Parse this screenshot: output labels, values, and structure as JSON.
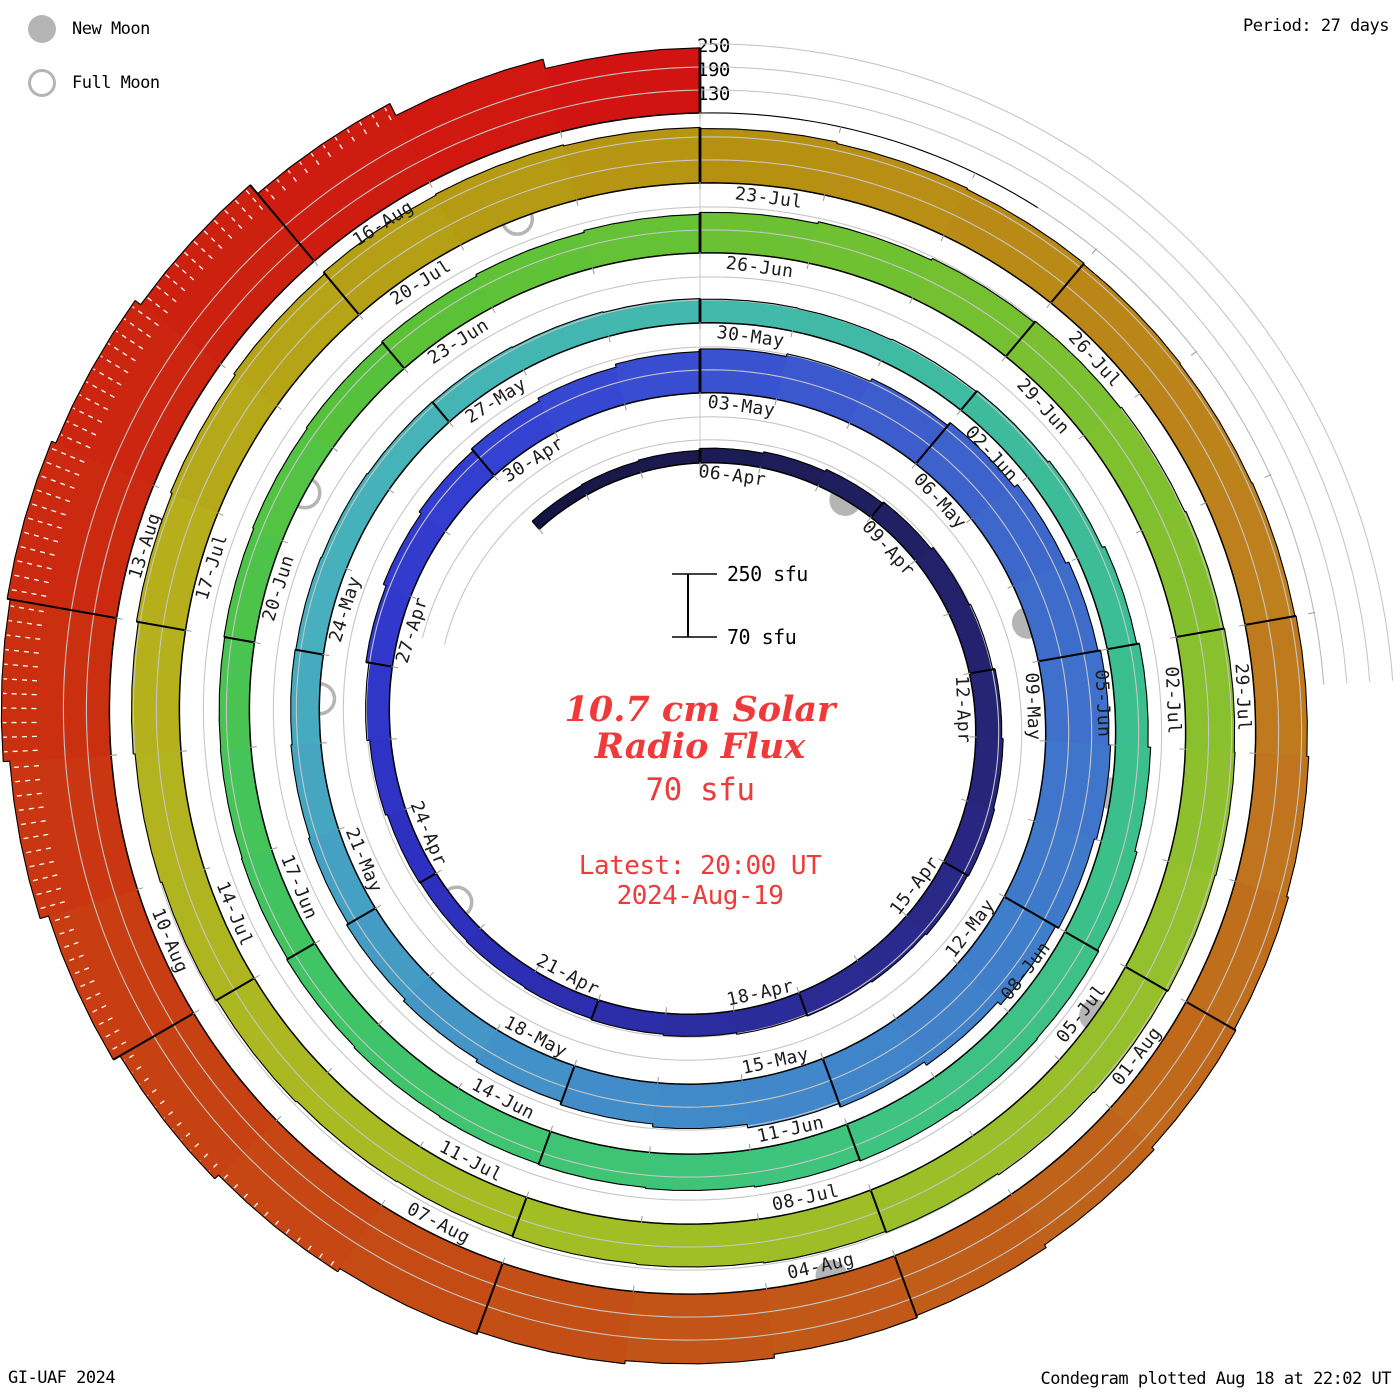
{
  "header": {
    "period_label": "Period: 27 days"
  },
  "legend": {
    "new_moon": "New Moon",
    "full_moon": "Full Moon"
  },
  "footer": {
    "left": "GI-UAF 2024",
    "right": "Condegram plotted Aug 18 at 22:02 UT"
  },
  "center": {
    "title_line1": "10.7 cm Solar",
    "title_line2": "Radio Flux",
    "value": "70 sfu",
    "latest_line1": "Latest: 20:00 UT",
    "latest_line2": "2024-Aug-19"
  },
  "scale": {
    "top": "250 sfu",
    "bottom": "70 sfu"
  },
  "axis": {
    "tick_labels": [
      "250",
      "190",
      "130"
    ]
  },
  "chart_data": {
    "type": "spiral_bar",
    "title": "10.7 cm Solar Radio Flux condegram",
    "period_days": 27,
    "segment_days": 3,
    "baseline_sfu": 70,
    "gridlines_sfu": [
      130,
      190,
      250
    ],
    "start_date": "2024-04-03",
    "end_date": "2024-08-19",
    "ring_start_labels": [
      "06-Apr",
      "03-May",
      "30-May",
      "26-Jun",
      "23-Jul"
    ],
    "segment_labels": [
      "06-Apr",
      "09-Apr",
      "12-Apr",
      "15-Apr",
      "18-Apr",
      "21-Apr",
      "24-Apr",
      "27-Apr",
      "30-Apr",
      "03-May",
      "06-May",
      "09-May",
      "12-May",
      "15-May",
      "18-May",
      "21-May",
      "24-May",
      "27-May",
      "30-May",
      "02-Jun",
      "05-Jun",
      "08-Jun",
      "11-Jun",
      "14-Jun",
      "17-Jun",
      "20-Jun",
      "23-Jun",
      "26-Jun",
      "29-Jun",
      "02-Jul",
      "05-Jul",
      "08-Jul",
      "11-Jul",
      "14-Jul",
      "17-Jul",
      "20-Jul",
      "23-Jul",
      "26-Jul",
      "29-Jul",
      "01-Aug",
      "04-Aug",
      "07-Aug",
      "10-Aug",
      "13-Aug",
      "16-Aug"
    ],
    "daily_flux_sfu": [
      98,
      100,
      103,
      108,
      112,
      118,
      122,
      128,
      132,
      138,
      142,
      145,
      142,
      138,
      135,
      132,
      128,
      125,
      122,
      120,
      118,
      120,
      125,
      132,
      140,
      148,
      155,
      162,
      170,
      178,
      185,
      192,
      200,
      210,
      220,
      228,
      235,
      240,
      234,
      225,
      215,
      205,
      195,
      186,
      178,
      170,
      163,
      157,
      152,
      148,
      145,
      143,
      141,
      139,
      138,
      136,
      134,
      132,
      131,
      133,
      136,
      141,
      148,
      155,
      162,
      168,
      172,
      174,
      172,
      168,
      165,
      162,
      160,
      158,
      155,
      152,
      150,
      149,
      151,
      154,
      157,
      161,
      166,
      171,
      176,
      181,
      186,
      190,
      193,
      196,
      198,
      200,
      198,
      195,
      192,
      188,
      185,
      182,
      180,
      178,
      180,
      183,
      186,
      190,
      195,
      200,
      205,
      210,
      215,
      218,
      215,
      212,
      208,
      205,
      202,
      200,
      202,
      205,
      210,
      215,
      220,
      228,
      236,
      242,
      252,
      260,
      268,
      278,
      292,
      312,
      335,
      352,
      360,
      348,
      330,
      300,
      265,
      240
    ],
    "moons": {
      "new": [
        {
          "date": "2024-04-08",
          "day": 5
        },
        {
          "date": "2024-05-08",
          "day": 35
        },
        {
          "date": "2024-06-06",
          "day": 64
        },
        {
          "date": "2024-07-05",
          "day": 93
        },
        {
          "date": "2024-08-04",
          "day": 123
        }
      ],
      "full": [
        {
          "date": "2024-04-23",
          "day": 20
        },
        {
          "date": "2024-05-23",
          "day": 50
        },
        {
          "date": "2024-06-21",
          "day": 79
        },
        {
          "date": "2024-07-21",
          "day": 109
        }
      ]
    },
    "color_stops": [
      [
        0,
        "#141440"
      ],
      [
        3,
        "#1b1b52"
      ],
      [
        9,
        "#252371"
      ],
      [
        15,
        "#2b2b96"
      ],
      [
        21,
        "#2d2fc0"
      ],
      [
        27,
        "#333fd2"
      ],
      [
        33,
        "#3e60cc"
      ],
      [
        39,
        "#3f7cca"
      ],
      [
        45,
        "#428ec9"
      ],
      [
        51,
        "#47aebe"
      ],
      [
        57,
        "#41b9ad"
      ],
      [
        63,
        "#3bbd92"
      ],
      [
        69,
        "#3ec47e"
      ],
      [
        75,
        "#3fc464"
      ],
      [
        81,
        "#58c238"
      ],
      [
        87,
        "#78c030"
      ],
      [
        93,
        "#95c02c"
      ],
      [
        99,
        "#a4bd24"
      ],
      [
        105,
        "#b6b01c"
      ],
      [
        111,
        "#b59310"
      ],
      [
        117,
        "#bf7d1e"
      ],
      [
        123,
        "#c05a18"
      ],
      [
        129,
        "#c84012"
      ],
      [
        132,
        "#ca2c10"
      ],
      [
        138,
        "#d21111"
      ]
    ],
    "colors": {
      "moon": "#b5b5b5",
      "grid": "#c6c6c6",
      "baseline": "#000000",
      "tick": "#999999",
      "label": "#1b1b1b",
      "accent_red": "#ee3a3a"
    },
    "layout": {
      "legend_position": "top-left",
      "grid": true
    }
  }
}
